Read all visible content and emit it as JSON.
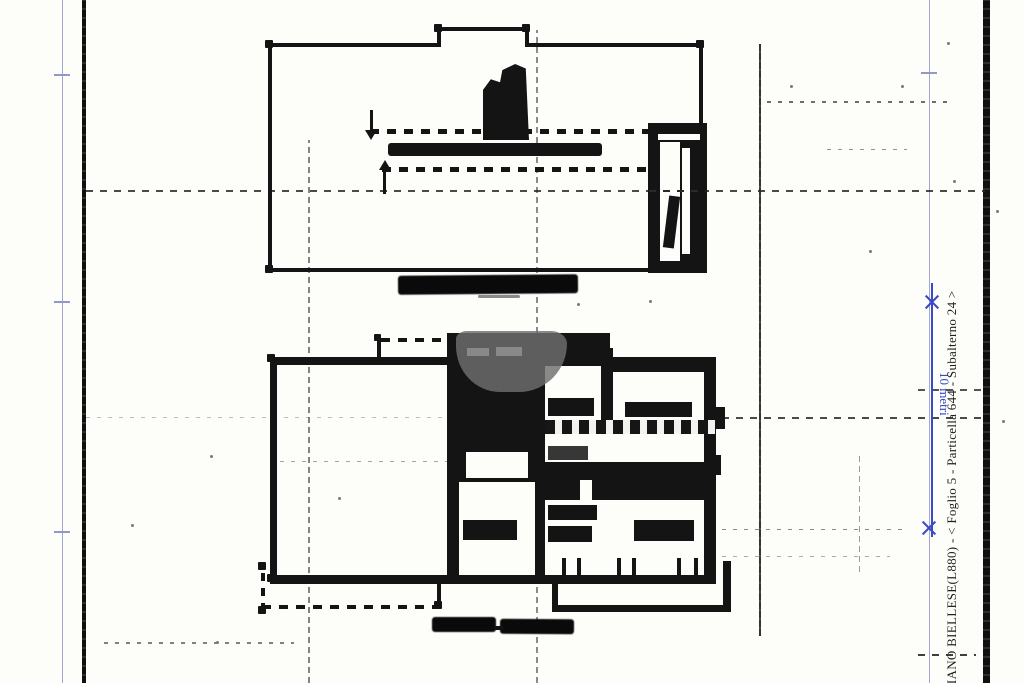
{
  "sheet": {
    "side_annotation": "GLIANO BIELLESE(L880) - < Foglio 5 - Particella 644 - Subalterno 24 >",
    "scale_label": "10 metri"
  },
  "colors": {
    "paper": "#fdfdfa",
    "ink": "#141414",
    "artifact_gray": "#6a6a6a",
    "fold_line_blue": "#9097c9",
    "scale_blue": "#3a49c4",
    "annotation_black": "#1f1f1f",
    "watermark_gray": "#6f6f6f"
  }
}
